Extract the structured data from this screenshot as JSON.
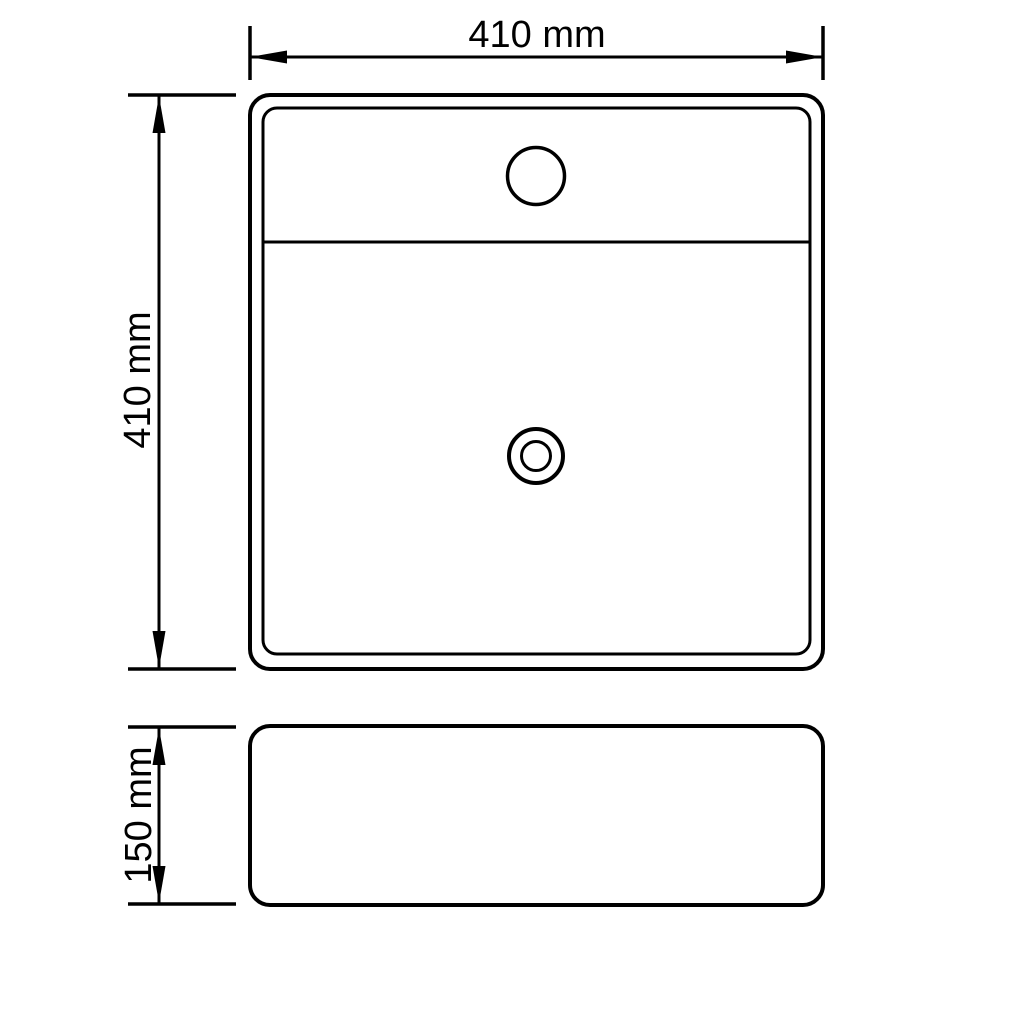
{
  "page": {
    "background_color": "#ffffff",
    "ink_color": "#000000"
  },
  "drawing": {
    "type": "technical-drawing",
    "views": {
      "top_view": {
        "features": [
          "faucet-hole",
          "deck-divider-line",
          "drain-hole",
          "inner-rim"
        ]
      },
      "front_view": {
        "features": []
      }
    },
    "dimensions": {
      "width": {
        "label": "410 mm",
        "value": 410,
        "unit": "mm",
        "orientation": "horizontal"
      },
      "depth": {
        "label": "410 mm",
        "value": 410,
        "unit": "mm",
        "orientation": "vertical"
      },
      "height": {
        "label": "150 mm",
        "value": 150,
        "unit": "mm",
        "orientation": "vertical"
      }
    }
  }
}
